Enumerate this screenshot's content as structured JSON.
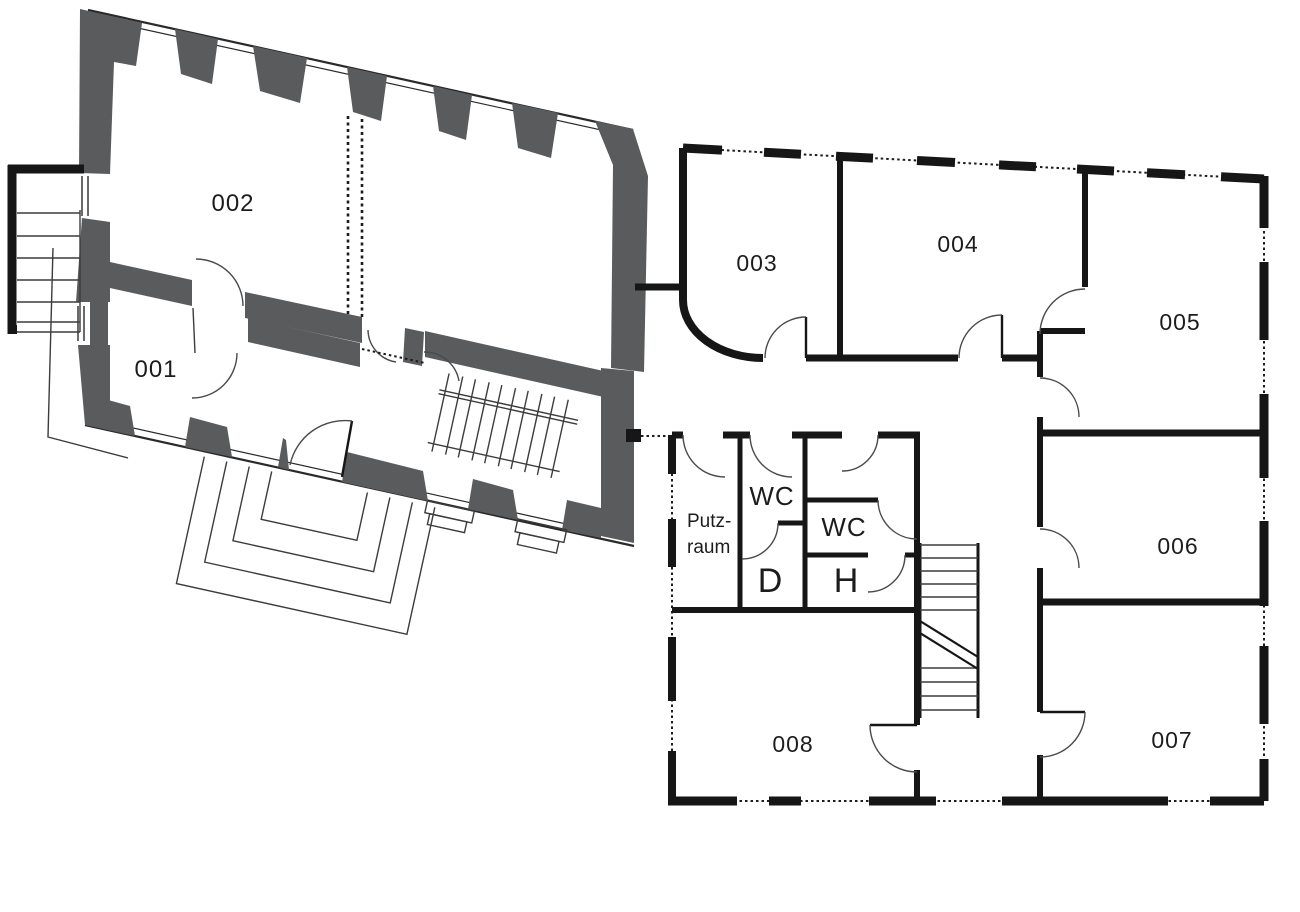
{
  "page": {
    "background": "#ffffff"
  },
  "colors": {
    "old_building_wall": "#5a5b5c",
    "new_building_wall": "#161616",
    "thin_line": "#3c3c3c",
    "label_text": "#1c1c1c"
  },
  "old_building": {
    "description": "historic wing with thick gray masonry walls, drawn rotated",
    "rooms": [
      {
        "id": "001",
        "label": "001"
      },
      {
        "id": "002",
        "label": "002"
      }
    ],
    "features": [
      "exterior-stair-west",
      "entrance-steps",
      "interior-stair",
      "removed-wall-dashed-lines",
      "splayed-window-reveals"
    ]
  },
  "new_building": {
    "description": "orthogonal wing with black walls and dashed window axes",
    "rooms": [
      {
        "id": "003",
        "label": "003"
      },
      {
        "id": "004",
        "label": "004"
      },
      {
        "id": "005",
        "label": "005"
      },
      {
        "id": "006",
        "label": "006"
      },
      {
        "id": "007",
        "label": "007"
      },
      {
        "id": "008",
        "label": "008"
      },
      {
        "id": "putzraum",
        "label_line1": "Putz-",
        "label_line2": "raum"
      },
      {
        "id": "wc_left",
        "label": "WC"
      },
      {
        "id": "wc_right",
        "label": "WC"
      },
      {
        "id": "damen",
        "label": "D"
      },
      {
        "id": "herren",
        "label": "H"
      }
    ],
    "features": [
      "central-stair",
      "corridor",
      "dashed-window-walls"
    ]
  },
  "labels": {
    "r001": "001",
    "r002": "002",
    "r003": "003",
    "r004": "004",
    "r005": "005",
    "r006": "006",
    "r007": "007",
    "r008": "008",
    "wc_left": "WC",
    "wc_right": "WC",
    "d": "D",
    "h": "H",
    "putz1": "Putz-",
    "putz2": "raum"
  }
}
